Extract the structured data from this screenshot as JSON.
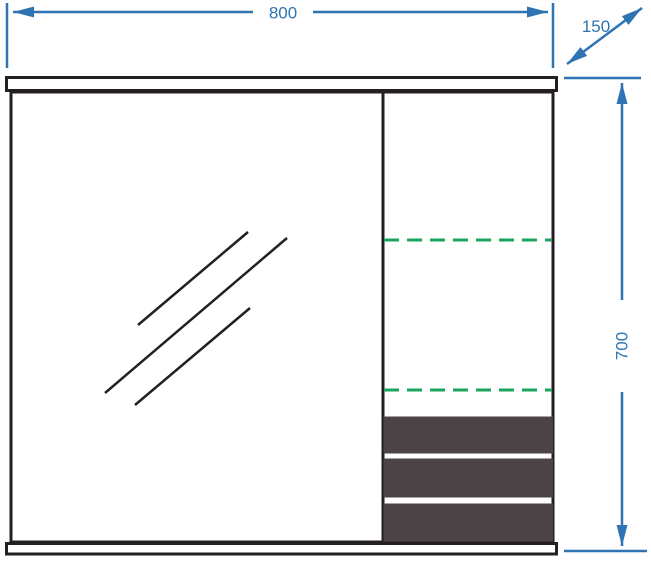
{
  "drawing": {
    "kind": "furniture-technical-drawing",
    "dimensions": {
      "width": {
        "label": "800"
      },
      "depth": {
        "label": "150"
      },
      "height": {
        "label": "700"
      }
    },
    "colors": {
      "dimension_blue": "#2f74b2",
      "outline_black": "#242021",
      "shelf_dash_green": "#1aa45e",
      "drawer_fill": "#4b4345",
      "background": "#ffffff"
    }
  }
}
